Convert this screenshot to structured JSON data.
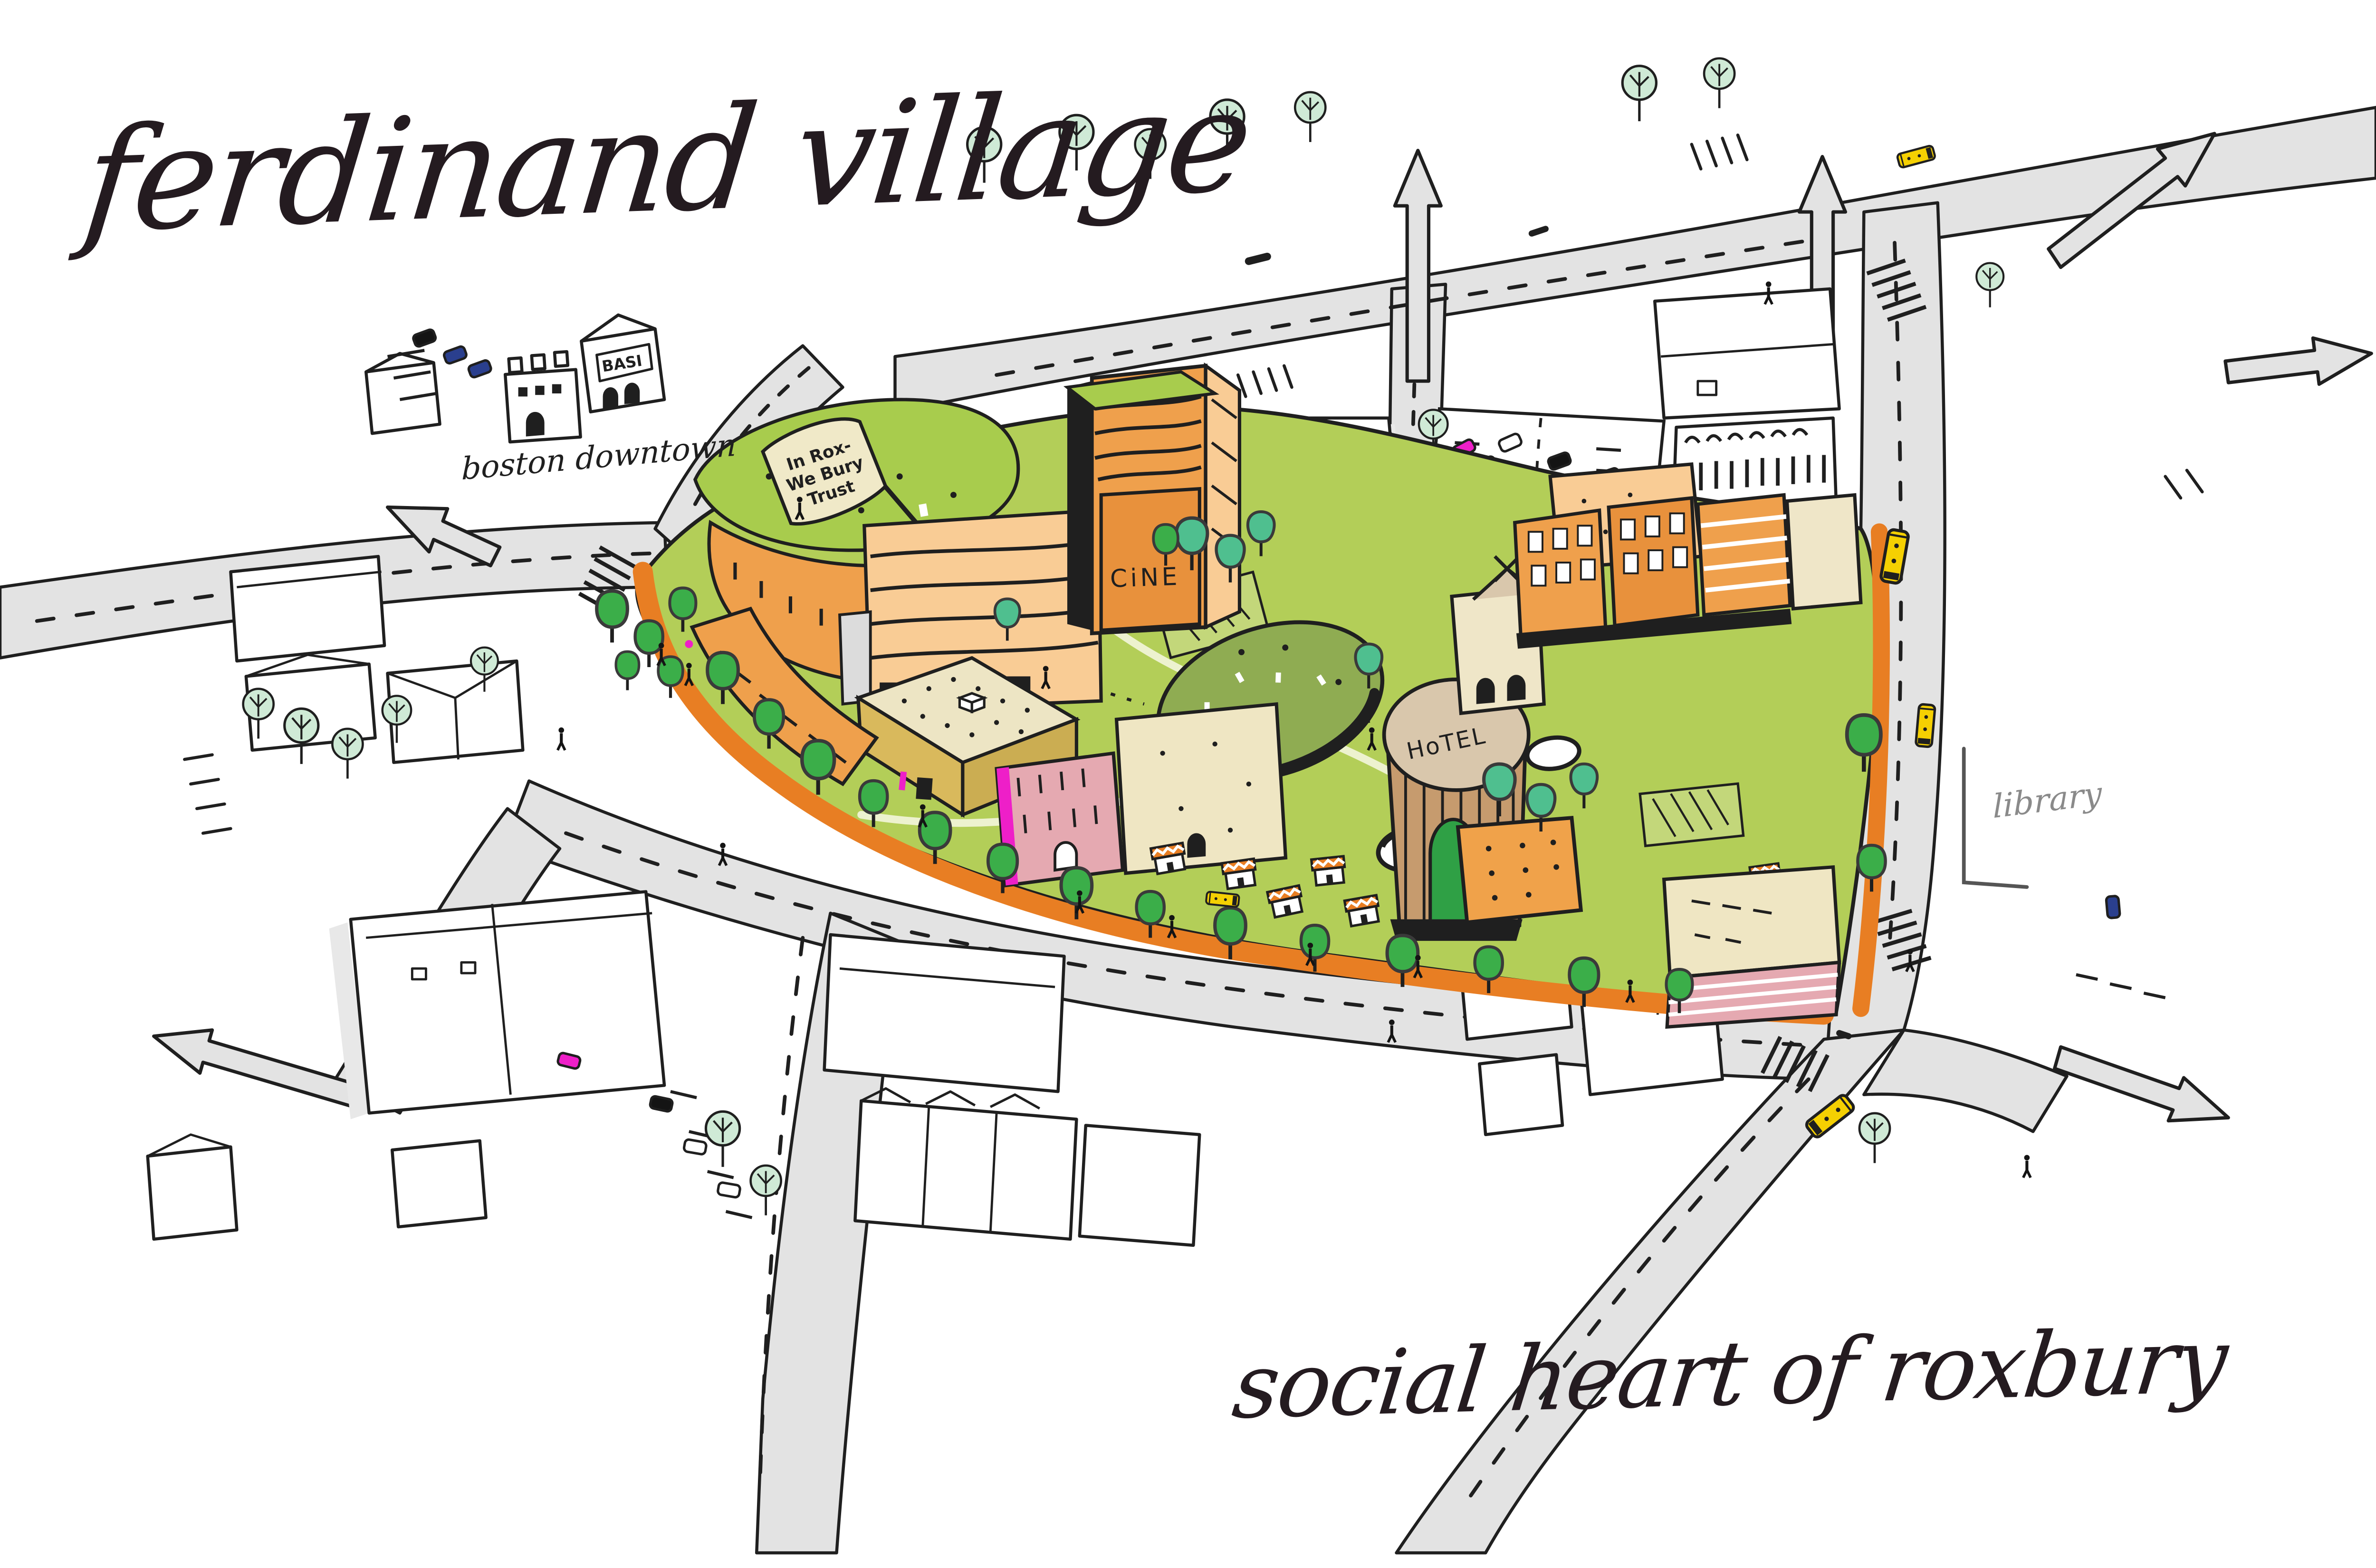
{
  "title": "ferdinand village",
  "subtitle": "social heart of roxbury",
  "labels": {
    "district_direction": "boston downtown",
    "library": "library",
    "cine": "CiNE",
    "hotel": "HoTEL",
    "hotel_mark": "M",
    "shop_sign": "BASI"
  },
  "banner": {
    "text": "In Roxbury We Trust",
    "lines": [
      "In Rox-",
      "We Bury",
      "Trust"
    ]
  },
  "colors": {
    "ink": "#1F1F1F",
    "boundary_orange": "#E87E23",
    "park_green": "#B3CE58",
    "mound_green": "#8FAC52",
    "roof_green": "#A8CC4D",
    "building_orange": "#EFA04C",
    "building_orange_dark": "#E8913C",
    "building_peach": "#F9CC95",
    "building_cream": "#EFE6C3",
    "building_khaki": "#D9B95C",
    "building_pink": "#E5A9B1",
    "hotel_brown": "#C69B6E",
    "hotel_top_tan": "#D9C7AC",
    "tree_green": "#3BAE49",
    "tree_teal": "#4FBF8F",
    "tree_mint": "#CFEAD6",
    "road_gray": "#E3E3E3",
    "bus_yellow": "#F5D002",
    "car_magenta": "#EE1FC8",
    "car_navy": "#2A3F8E",
    "banner_cream": "#F0E9C8",
    "label_gray": "#8A8A8A"
  }
}
